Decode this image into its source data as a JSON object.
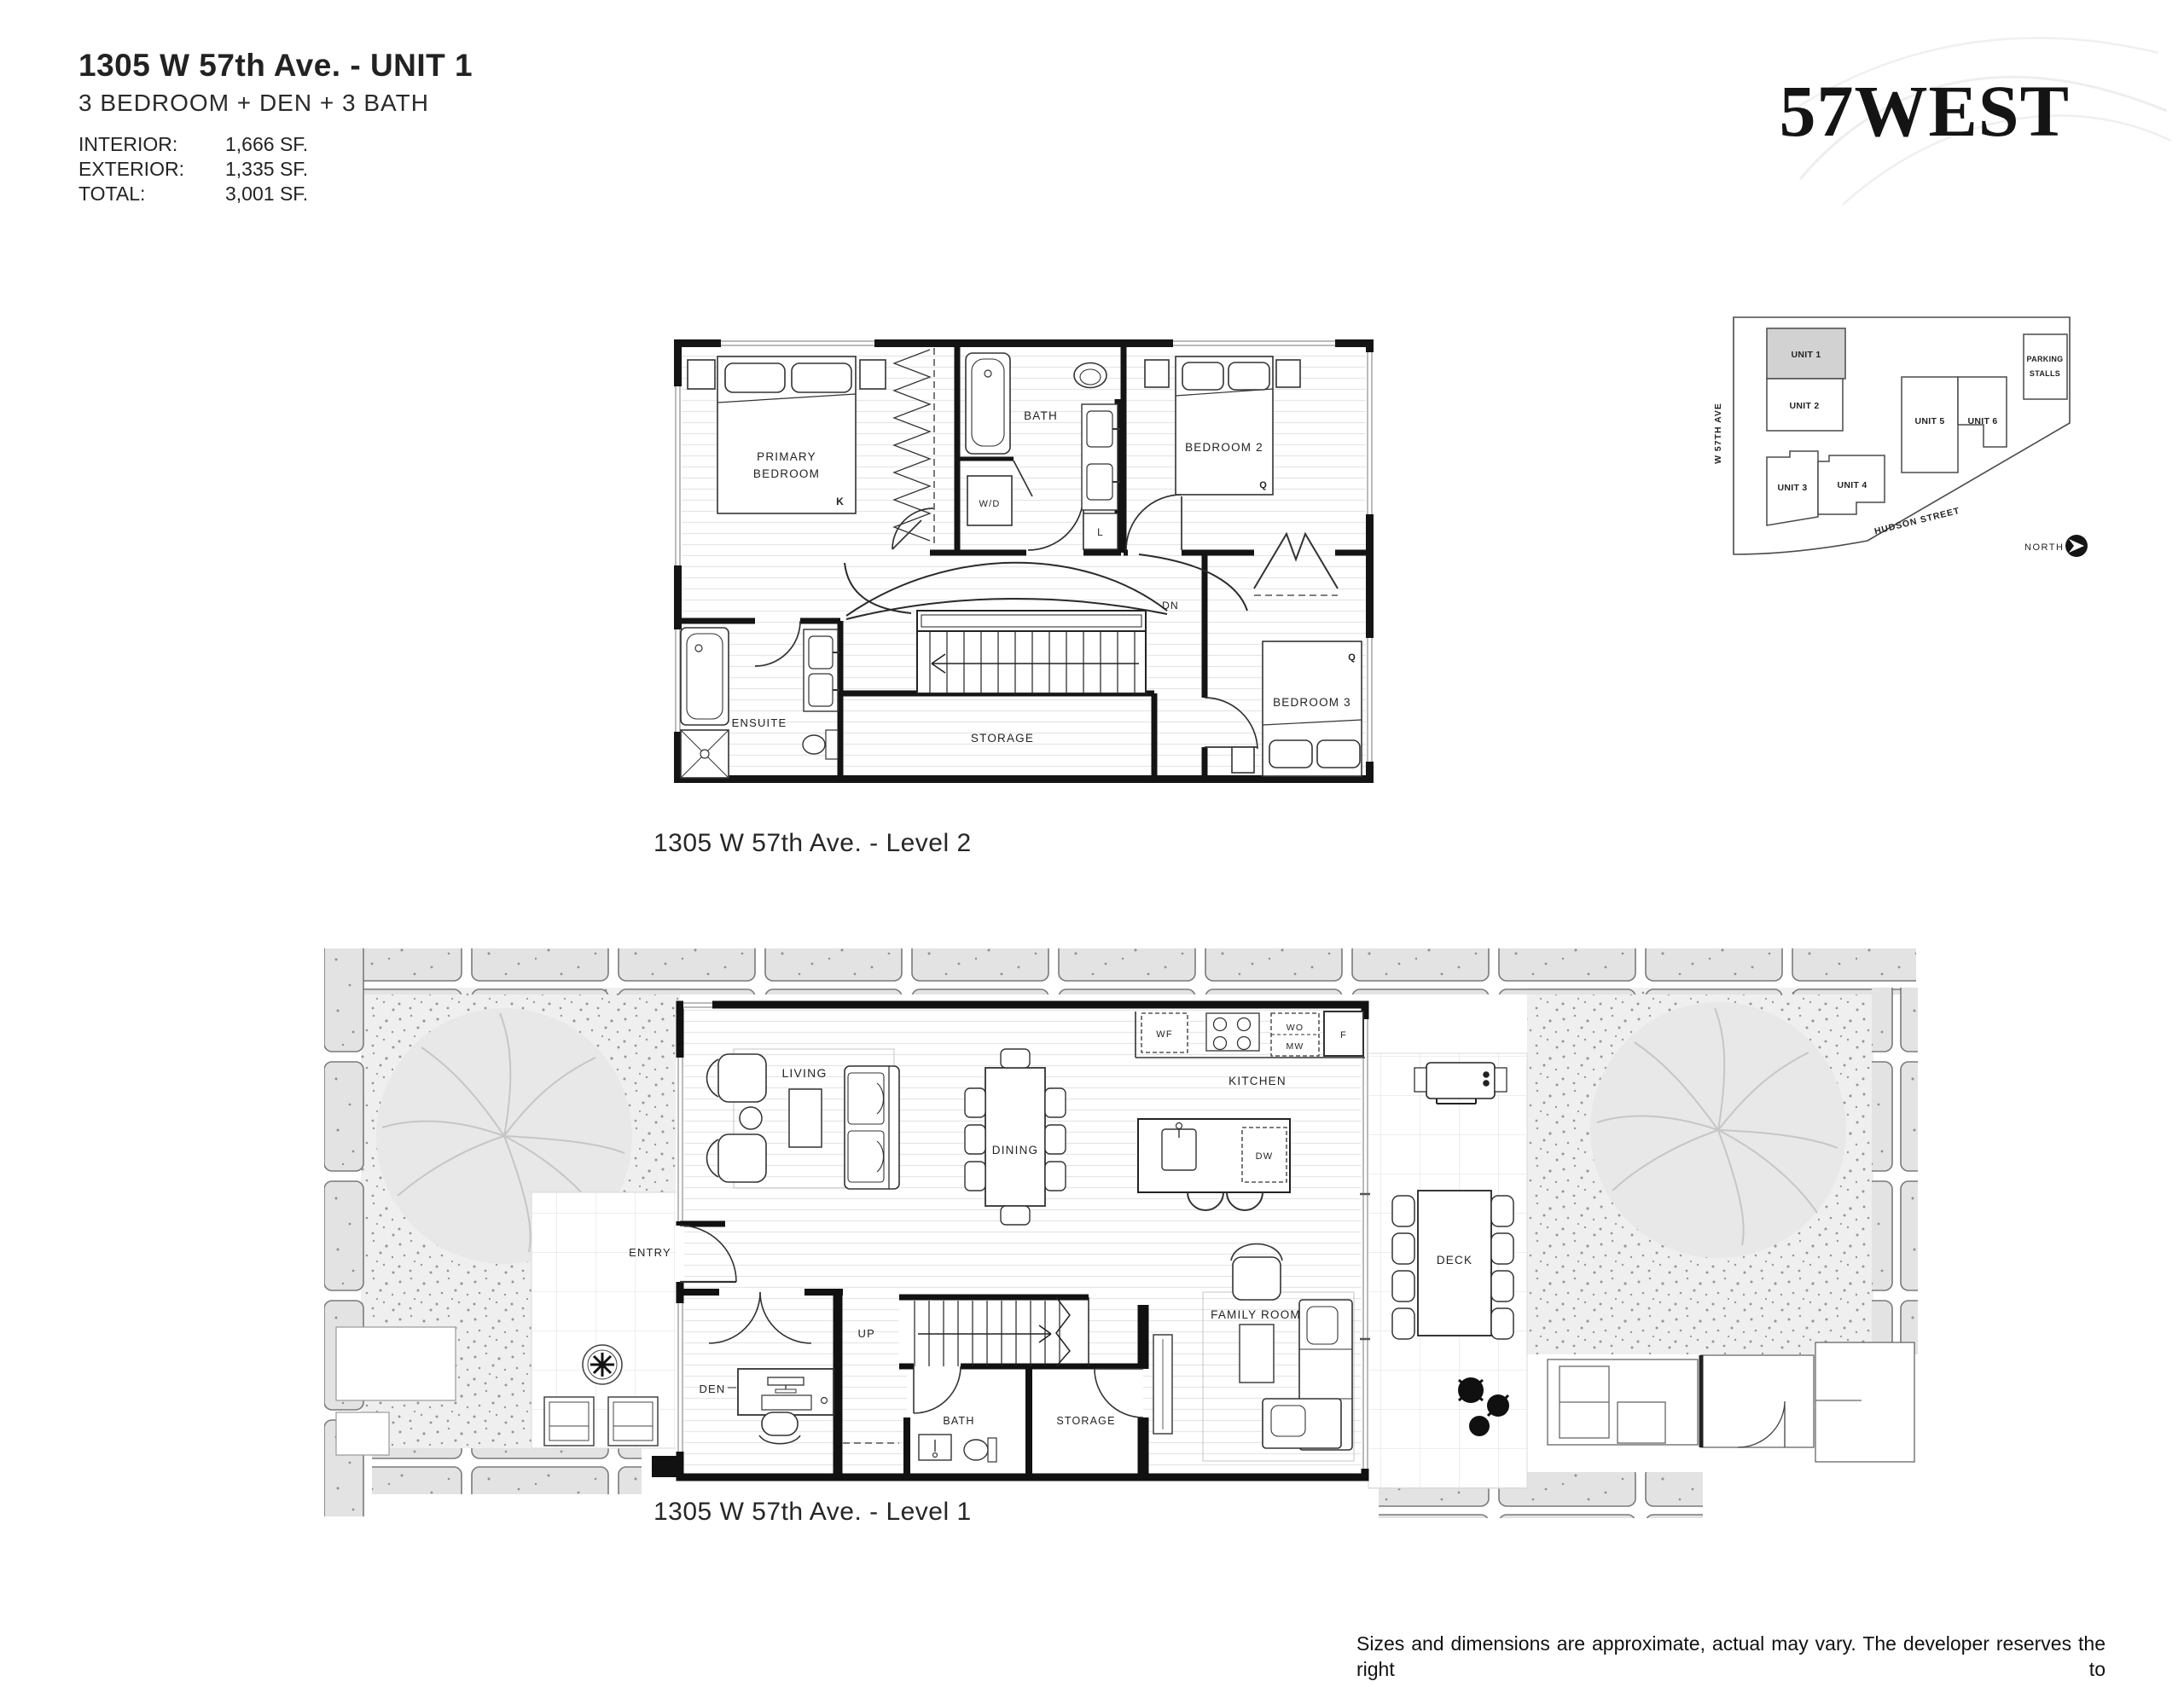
{
  "header": {
    "title": "1305 W 57th Ave. - UNIT 1",
    "subtitle": "3 BEDROOM + DEN + 3 BATH",
    "stats": [
      {
        "label": "INTERIOR:",
        "value": "1,666 SF."
      },
      {
        "label": "EXTERIOR:",
        "value": "1,335 SF."
      },
      {
        "label": "TOTAL:",
        "value": "3,001 SF."
      }
    ]
  },
  "logo": {
    "text": "57WEST"
  },
  "site_plan": {
    "street_left": "W 57TH AVE",
    "street_bottom": "HUDSON STREET",
    "north_label": "NORTH",
    "highlight_color": "#d2d2d2",
    "units": [
      {
        "label": "UNIT 1",
        "highlighted": true
      },
      {
        "label": "UNIT 2",
        "highlighted": false
      },
      {
        "label": "UNIT 3",
        "highlighted": false
      },
      {
        "label": "UNIT 4",
        "highlighted": false
      },
      {
        "label": "UNIT 5",
        "highlighted": false
      },
      {
        "label": "UNIT 6",
        "highlighted": false
      }
    ],
    "parking": {
      "line1": "PARKING",
      "line2": "STALLS"
    }
  },
  "level2": {
    "caption": "1305 W 57th Ave. - Level 2",
    "labels": {
      "primary_line1": "PRIMARY",
      "primary_line2": "BEDROOM",
      "bath": "BATH",
      "wd": "W/D",
      "linen": "L",
      "bedroom2": "BEDROOM 2",
      "dn": "DN",
      "ensuite": "ENSUITE",
      "storage": "STORAGE",
      "bedroom3": "BEDROOM 3",
      "bed_king": "K",
      "bed_queen2": "Q",
      "bed_queen3": "Q"
    }
  },
  "level1": {
    "caption": "1305 W 57th Ave. - Level 1",
    "labels": {
      "entry": "ENTRY",
      "living": "LIVING",
      "dining": "DINING",
      "den": "DEN",
      "up": "UP",
      "storage": "STORAGE",
      "bath": "BATH",
      "kitchen": "KITCHEN",
      "wine_fridge": "WF",
      "wall_oven": "WO",
      "microwave": "MW",
      "fridge": "F",
      "dishwasher": "DW",
      "family_room": "FAMILY ROOM",
      "deck": "DECK"
    }
  },
  "disclaimer": {
    "lines": [
      "Sizes and dimensions are approximate, actual may vary. The developer reserves the right to",
      "make changes and modifications to the information contained herein without prior notice. E.&O.E."
    ]
  }
}
